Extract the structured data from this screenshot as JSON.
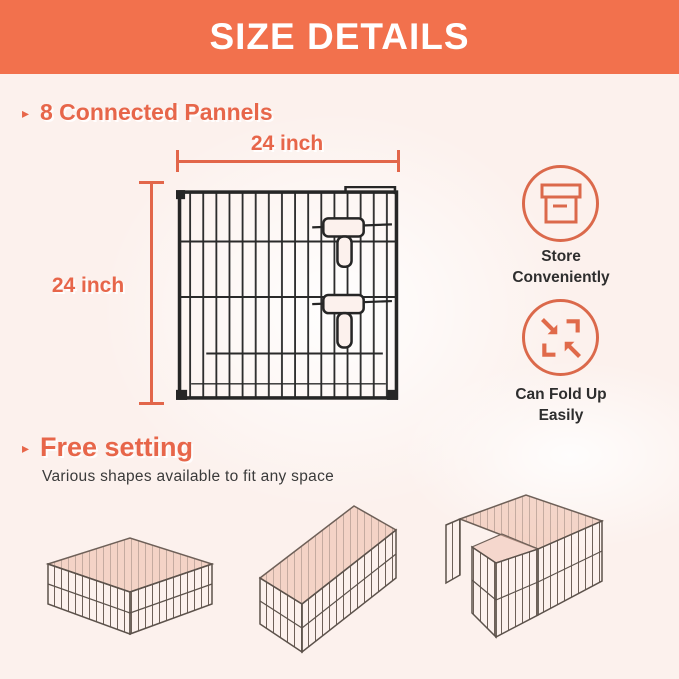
{
  "header": {
    "title": "SIZE DETAILS"
  },
  "panels_section": {
    "bullet": "▸",
    "heading": "8 Connected Pannels",
    "width_label": "24 inch",
    "height_label": "24 inch"
  },
  "features": {
    "store": {
      "icon": "storage-box-icon",
      "line1": "Store",
      "line2": "Conveniently"
    },
    "fold": {
      "icon": "fold-arrows-icon",
      "line1": "Can Fold Up",
      "line2": "Easily"
    }
  },
  "free_section": {
    "bullet": "▸",
    "heading": "Free setting",
    "subtitle": "Various shapes available to fit any space",
    "shapes": [
      "square pen",
      "long rectangle pen",
      "L-shaped pen"
    ]
  },
  "colors": {
    "header_bg": "#F2714D",
    "accent": "#E7664A",
    "icon_stroke": "#DB694B",
    "background": "#FCF1ED",
    "dark_text": "#2E2E2E",
    "panel_wire": "#2A2A2A",
    "pen_wire": "#6E6058",
    "pen_top_tint": "#EDB9A6"
  }
}
